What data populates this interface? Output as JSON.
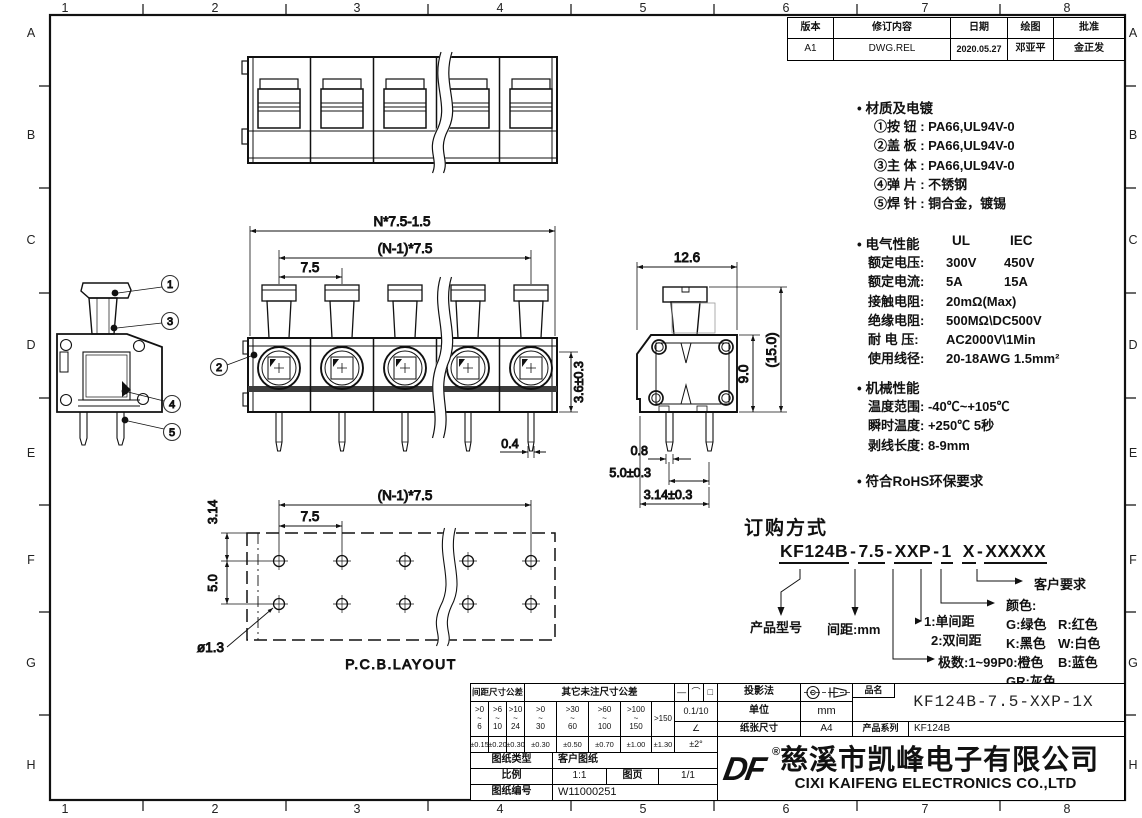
{
  "border": {
    "cols": [
      "1",
      "2",
      "3",
      "4",
      "5",
      "6",
      "7",
      "8"
    ],
    "rows": [
      "A",
      "B",
      "C",
      "D",
      "E",
      "F",
      "G",
      "H"
    ]
  },
  "revision": {
    "headers": [
      "版本",
      "修订内容",
      "日期",
      "绘图",
      "批准"
    ],
    "cells": [
      "A1",
      "DWG.REL",
      "2020.05.27",
      "邓亚平",
      "金正发"
    ]
  },
  "notes": {
    "bullet": "•",
    "material_title": "材质及电镀",
    "material_items": [
      "①按 钮 : PA66,UL94V-0",
      "②盖 板 : PA66,UL94V-0",
      "③主 体 : PA66,UL94V-0",
      "④弹 片 : 不锈钢",
      "⑤焊 针 : 铜合金，镀锡"
    ],
    "electrical_title": "电气性能",
    "electrical_col1": "UL",
    "electrical_col2": "IEC",
    "electrical_rows": [
      {
        "label": "额定电压:",
        "ul": "300V",
        "iec": "450V"
      },
      {
        "label": "额定电流:",
        "ul": "5A",
        "iec": "15A"
      },
      {
        "label": "接触电阻:",
        "ul": "20mΩ(Max)",
        "iec": ""
      },
      {
        "label": "绝缘电阻:",
        "ul": "500MΩ\\DC500V",
        "iec": ""
      },
      {
        "label": "耐 电 压:",
        "ul": "AC2000V\\1Min",
        "iec": ""
      },
      {
        "label": "使用线径:",
        "ul": "20-18AWG 1.5mm²",
        "iec": ""
      }
    ],
    "mechanical_title": "机械性能",
    "mechanical_rows": [
      "温度范围: -40℃~+105℃",
      "瞬时温度: +250℃ 5秒",
      "剥线长度: 8-9mm"
    ],
    "rohs": "符合RoHS环保要求"
  },
  "ordering": {
    "title": "订购方式",
    "segments": [
      "KF124B",
      "7.5",
      "XXP",
      "1",
      "X",
      "XXXXX"
    ],
    "sep": "-",
    "labels": {
      "model": "产品型号",
      "pitch": "间距:mm",
      "pole_type_1": "1:单间距",
      "pole_type_2": "2:双间距",
      "poles": "极数:1~99P",
      "color_title": "颜色:",
      "colors": [
        [
          "G:绿色",
          "R:红色"
        ],
        [
          "K:黑色",
          "W:白色"
        ],
        [
          "0:橙色",
          "B:蓝色"
        ],
        [
          "GR:灰色",
          ""
        ]
      ],
      "customer": "客户要求"
    }
  },
  "dims": {
    "total_width": "N*7.5-1.5",
    "span": "(N-1)*7.5",
    "pitch": "7.5",
    "body_h": "3.6±0.3",
    "pin_w_front": "0.4",
    "side_w": "12.6",
    "side_h": "9.0",
    "side_h_total": "(15.0)",
    "pin_w_side": "0.8",
    "pin_pitch_side": "5.0±0.3",
    "pin_offset_side": "3.14±0.3",
    "pcb_span": "(N-1)*7.5",
    "pcb_pitch": "7.5",
    "pcb_row_offset": "3.14",
    "pcb_row_pitch": "5.0",
    "pcb_hole": "ø1.3",
    "pcb_caption": "P.C.B.LAYOUT"
  },
  "balloons": {
    "one": "1",
    "two": "2",
    "three": "3",
    "four": "4",
    "five": "5"
  },
  "titleblock": {
    "tol_pitch_header": "间距尺寸公差",
    "tol_other_header": "其它未注尺寸公差",
    "range_sep": "~",
    "pitch_ranges": [
      {
        "a": ">0",
        "b": "6"
      },
      {
        "a": ">6",
        "b": "10"
      },
      {
        "a": ">10",
        "b": "24"
      }
    ],
    "other_ranges": [
      {
        "a": ">0",
        "b": "30"
      },
      {
        "a": ">30",
        "b": "60"
      },
      {
        "a": ">60",
        "b": "100"
      },
      {
        "a": ">100",
        "b": "150"
      }
    ],
    "over_range": ">150",
    "pitch_tols": [
      "±0.15",
      "±0.20",
      "±0.30"
    ],
    "other_tols": [
      "±0.30",
      "±0.50",
      "±0.70",
      "±1.00",
      "±1.30"
    ],
    "over_tol": "±1.30",
    "tol_symbols": [
      "—",
      "⌒",
      "□"
    ],
    "flat_tol": "0.1/10",
    "angle_symbol": "∠",
    "angle_tol": "±2°",
    "projection_label": "投影法",
    "unit_label": "单位",
    "unit_value": "mm",
    "paper_label": "纸张尺寸",
    "paper_value": "A4",
    "name_label": "品名",
    "name_value": "KF124B-7.5-XXP-1X",
    "series_label": "产品系列",
    "series_value": "KF124B",
    "doc_type_label": "图纸类型",
    "doc_type_value": "客户图纸",
    "scale_label": "比例",
    "scale_value": "1:1",
    "page_label": "图页",
    "page_value": "1/1",
    "doc_no_label": "图纸编号",
    "doc_no_value": "W11000251",
    "logo_text": "DF",
    "reg": "®",
    "company_cn": "慈溪市凯峰电子有限公司",
    "company_en": "CIXI KAIFENG ELECTRONICS CO.,LTD"
  }
}
